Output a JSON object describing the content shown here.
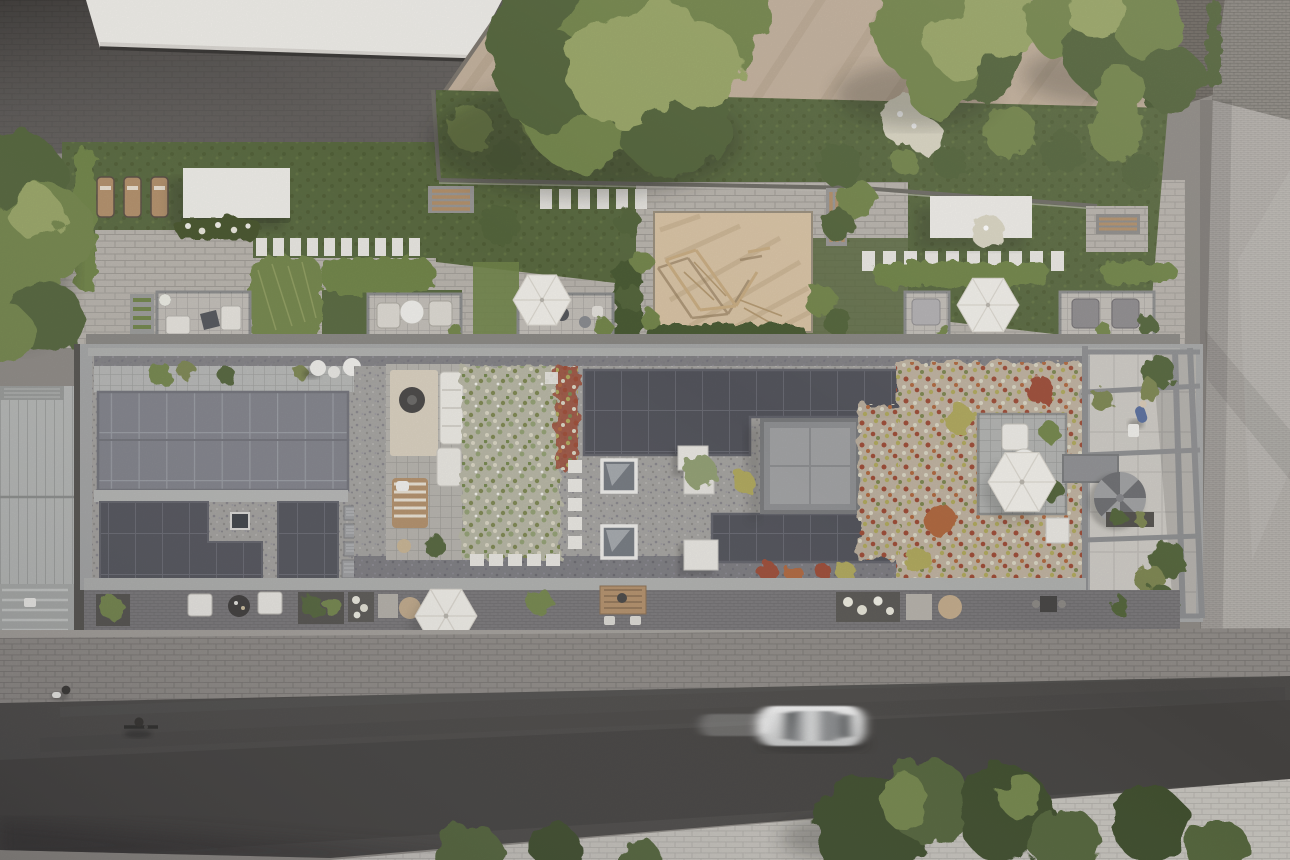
{
  "meta": {
    "title": "Aerial site-plan rendering — residential building with solar roof and courtyard garden",
    "description": "Top-down photorealistic rendering: elongated apartment building with rooftop photovoltaic arrays, sedum green roofs, roof terraces with parasols and a spiral stair atrium; landscaped courtyard with lawns, hedges, sand playground, sun loungers and pergolas to the north; paved plazas and neighbouring roofs above; sidewalk, asphalt street with a moving white car, cyclist and pedestrian with dog below.",
    "width": 1290,
    "height": 860
  },
  "colors": {
    "baseGray": "#8f8b86",
    "plazaDark": "#575350",
    "plazaEdge": "#3c3a38",
    "roofWhite": "#efede8",
    "roofWhiteShade": "#d9d6d1",
    "tanPlaza": "#c2b09c",
    "tanShade": "#a8957f",
    "cobbleDark": "#6e6963",
    "cobbleLine": "#5c5751",
    "brickLight": "#b6b2ad",
    "brickLine": "#a09c97",
    "lawn": "#5a6a41",
    "lawnDark": "#49562f",
    "hedge": "#71854a",
    "hedgeDark": "#4c5c35",
    "treeLight": "#9aa768",
    "treeMid": "#75874e",
    "treeDark": "#55663c",
    "treeDeep": "#414f2f",
    "sand": "#d8c3a5",
    "sandShade": "#c3ab8b",
    "paverLight": "#b9b4ad",
    "paverLine": "#a29d96",
    "stoneWhite": "#e9e7e2",
    "wood": "#b3916c",
    "woodDark": "#8a6f52",
    "parapet": "#a6a7a7",
    "walkway": "#b7b8b6",
    "gravel": "#a5a3a0",
    "gravelDark": "#7e7d82",
    "solarLight": "#83848c",
    "solarLightLine": "#9a9da4",
    "solarDark": "#54555d",
    "solarDarkLine": "#6a6b74",
    "veg1base": "#b7b6a4",
    "veg2base": "#bfb2a0",
    "vegSage": "#93a074",
    "vegOlive": "#7e8752",
    "vegCream": "#d9d5c3",
    "vegRed": "#9e4f3a",
    "vegRust": "#b06a42",
    "vegYellow": "#b0a95f",
    "deck": "#b2b3b1",
    "umbrella": "#f1efe9",
    "umbrellaShade": "#d9d5ce",
    "cube": "#909194",
    "cubeTop": "#a2a3a5",
    "atriumFloor": "#cdcac4",
    "beam": "#8e8f91",
    "stair": "#a0a1a3",
    "stairDark": "#6f7073",
    "metalRoof": "#b7b9b7",
    "metalSeam": "#a0a2a0",
    "terraceDark": "#7b797b",
    "rug": "#d9d0bf",
    "sidewalk": "#908c88",
    "road": "#4e4c4a",
    "roadDark": "#383634",
    "sidewalkSouth": "#c7c4be",
    "carBody": "#ececec",
    "carCabin": "#8c8e90",
    "white": "#f2f1ee",
    "personBlue": "#5a6f9e",
    "shadow": "#24231f"
  },
  "scene": {
    "north_area": {
      "label": "upper plazas and neighbouring roofs",
      "items": [
        "dark-paved-plaza",
        "white-neighbour-roof",
        "tan-diagonal-plaza",
        "cobble-wedge",
        "brick-neighbour-roof",
        "vertical-hedge"
      ]
    },
    "garden": {
      "label": "courtyard garden band",
      "items": [
        "lawns",
        "clipped-hedges",
        "ornamental-grasses",
        "flower-bed",
        "white-canopy",
        "white-canopy-2",
        "sun-lounger x3",
        "stepping-stones row x3",
        "sand-playground",
        "timber-climbing-frame",
        "garden-bench x3",
        "white-flowering-shrubs",
        "large-trees x4 clusters"
      ]
    },
    "patios": {
      "label": "ground-floor terraces on north side",
      "count": 5,
      "items": [
        "lounge-patio",
        "armchair-patio",
        "bistro-patio-with-parasol",
        "lounger-patio-with-parasol",
        "double-armchair-patio"
      ]
    },
    "building": {
      "label": "main building roof",
      "items": [
        "parapet",
        "paver-walkway",
        "pv-array-west (9x2 modules)",
        "pv-array-L-shaped",
        "pv-array-center",
        "pv-array-south",
        "hvac-unit x4",
        "skylight x2",
        "white-seat-cube x3",
        "elevator-cube",
        "roof-terrace-with-rug-sofa",
        "striped-lounger",
        "sedum-green-roof-west",
        "sedum-green-roof-east",
        "stepping-stones",
        "roof-deck",
        "roof-parasol",
        "white-sculpture x3",
        "atrium-court",
        "pergola-frame",
        "spiral-staircase",
        "walking-person"
      ]
    },
    "south_terrace": {
      "label": "south ground-floor terrace strip",
      "items": [
        "white-chair x2",
        "round-table",
        "planter x4",
        "flower-planter x2",
        "pale-stone-tile x2",
        "tan-stone-circle x2",
        "terrace-parasol",
        "timber-dining-set",
        "bistro-table"
      ]
    },
    "street": {
      "label": "street band",
      "items": [
        "north-sidewalk",
        "pedestrian-with-dog",
        "asphalt-road",
        "white-car-moving",
        "cyclist",
        "south-sidewalk",
        "street-tree x6"
      ]
    },
    "west_edge": {
      "label": "adjacent building",
      "items": [
        "standing-seam-metal-roof",
        "balcony-strip",
        "dark-hedge"
      ]
    }
  }
}
